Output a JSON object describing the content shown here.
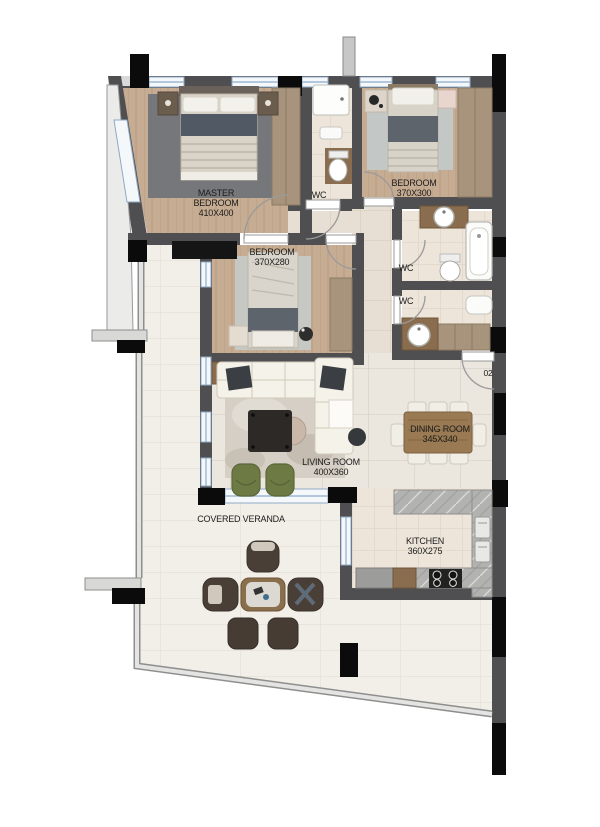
{
  "plan": {
    "unit_label": "02",
    "rooms": {
      "master_bedroom": {
        "name": "MASTER BEDROOM",
        "dims": "410X400"
      },
      "bedroom_2": {
        "name": "BEDROOM",
        "dims": "370X300"
      },
      "bedroom_3": {
        "name": "BEDROOM",
        "dims": "370X280"
      },
      "wc_top": {
        "name": "WC"
      },
      "wc_middle": {
        "name": "WC"
      },
      "wc_lower": {
        "name": "WC"
      },
      "living_room": {
        "name": "LIVING ROOM",
        "dims": "400X360"
      },
      "dining_room": {
        "name": "DINING ROOM",
        "dims": "345X340"
      },
      "kitchen": {
        "name": "KITCHEN",
        "dims": "360X275"
      },
      "veranda": {
        "name": "COVERED VERANDA"
      }
    },
    "colors": {
      "wall": "#4f4f51",
      "column": "#0b0b0b",
      "wood_floor": "#c6ac92",
      "window_blue": "#9db8d2",
      "armchair_olive": "#6e7a44",
      "counter_marble": "#b2b2b0"
    }
  }
}
